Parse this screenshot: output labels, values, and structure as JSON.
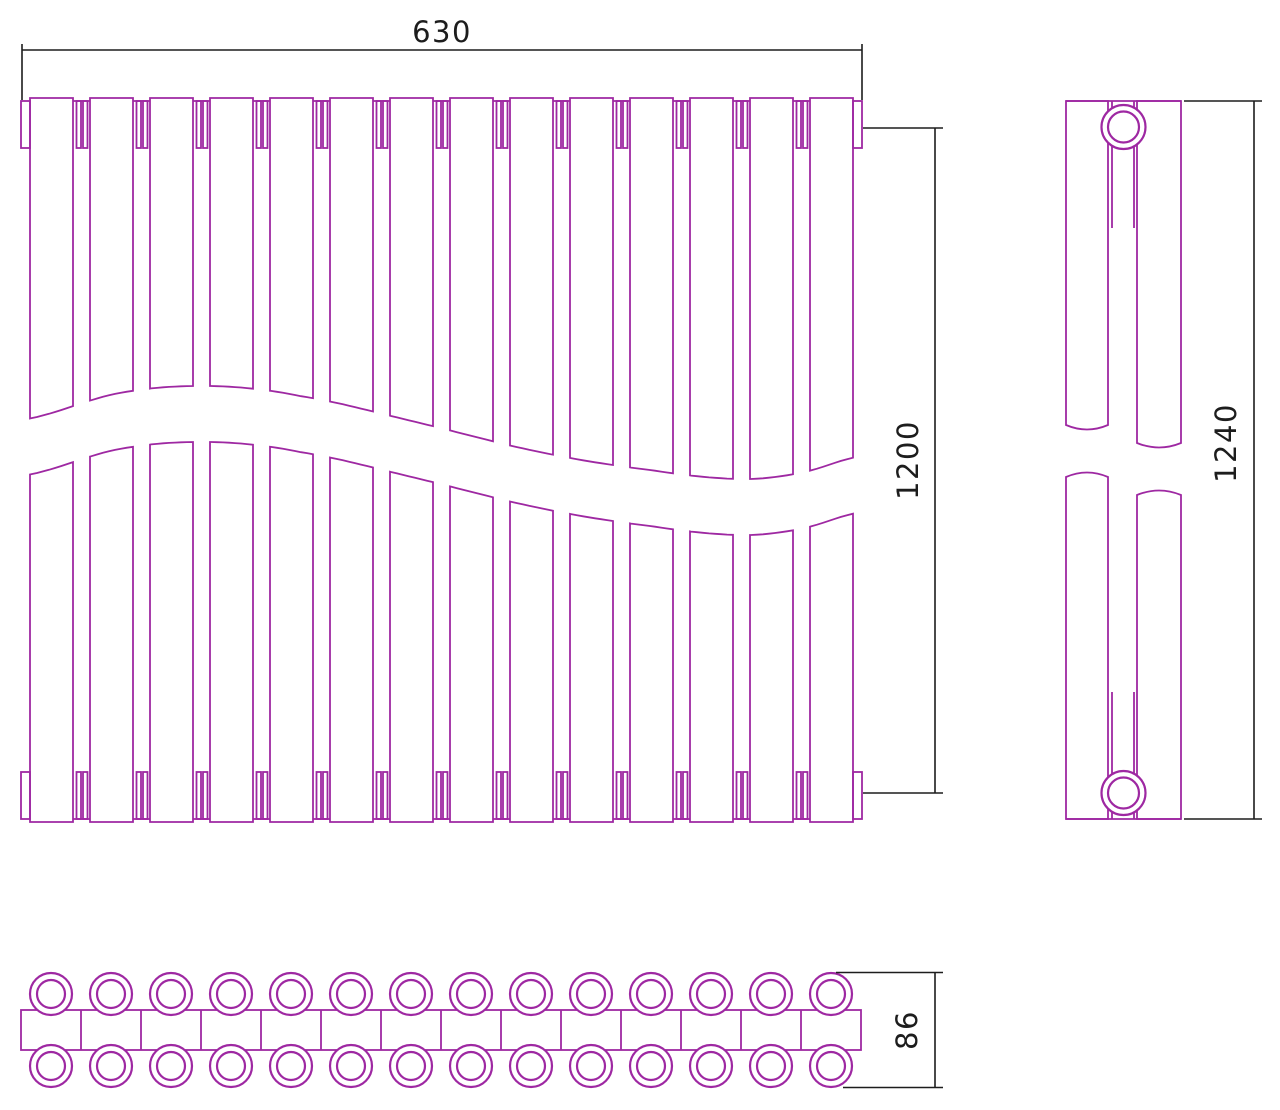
{
  "drawing": {
    "type": "radiator-technical-drawing",
    "colors": {
      "outline": "#9E28A2",
      "dimension": "#1d1d1d",
      "background": "#ffffff"
    },
    "front_view": {
      "sections": 14,
      "break_symbol": "s-curve-wave"
    },
    "side_view": {
      "tube_columns": 2,
      "connection_bosses": 2
    },
    "bottom_view": {
      "tubes_per_row": 14,
      "rows": 2
    },
    "dimensions": {
      "width": {
        "label": "630",
        "orientation": "horizontal"
      },
      "center_height": {
        "label": "1200",
        "orientation": "vertical"
      },
      "overall_height": {
        "label": "1240",
        "orientation": "vertical"
      },
      "depth": {
        "label": "86",
        "orientation": "vertical"
      }
    }
  }
}
